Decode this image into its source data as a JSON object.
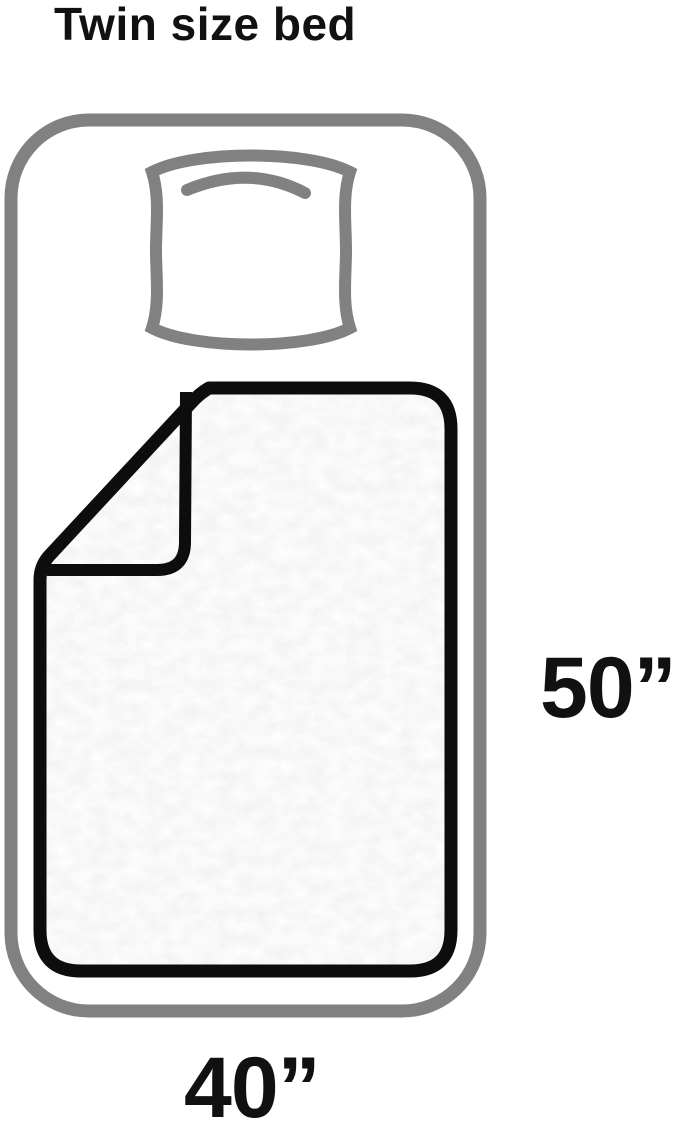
{
  "title": "Twin size bed",
  "dimensions": {
    "height_inches": "50”",
    "width_inches": "40”"
  },
  "colors": {
    "frame_gray": "#818181",
    "blanket_outline": "#0d0d0d",
    "blanket_fill": "#f0f0f0",
    "text": "#111111",
    "background": "#ffffff"
  },
  "icons": {
    "bed": "bed-frame-outline-icon",
    "pillow": "pillow-icon",
    "blanket": "folded-blanket-icon"
  }
}
